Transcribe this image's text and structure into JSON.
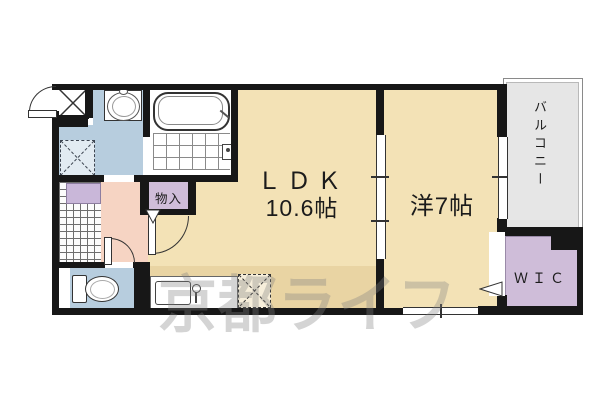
{
  "document": {
    "kind": "real-estate-floor-plan",
    "layout_type": "1LDK"
  },
  "rooms": {
    "ldk": {
      "label": "ＬＤＫ",
      "size": "10.6帖"
    },
    "western_room": {
      "label": "洋7帖"
    },
    "balcony": {
      "label": "バルコニー"
    },
    "walk_in_closet": {
      "label": "ＷＩＣ"
    },
    "storage": {
      "label": "物入"
    }
  },
  "watermark": {
    "text": "京都ライフ"
  },
  "colors": {
    "room_floor_tan": "#f3e2b6",
    "water_area_blue": "#b7cdde",
    "hallway_pink": "#f6d4c3",
    "closet_purple": "#cfbdd9",
    "balcony_gray": "#e6e6e6",
    "wall_black": "#171717",
    "watermark_gray": "#808080"
  }
}
